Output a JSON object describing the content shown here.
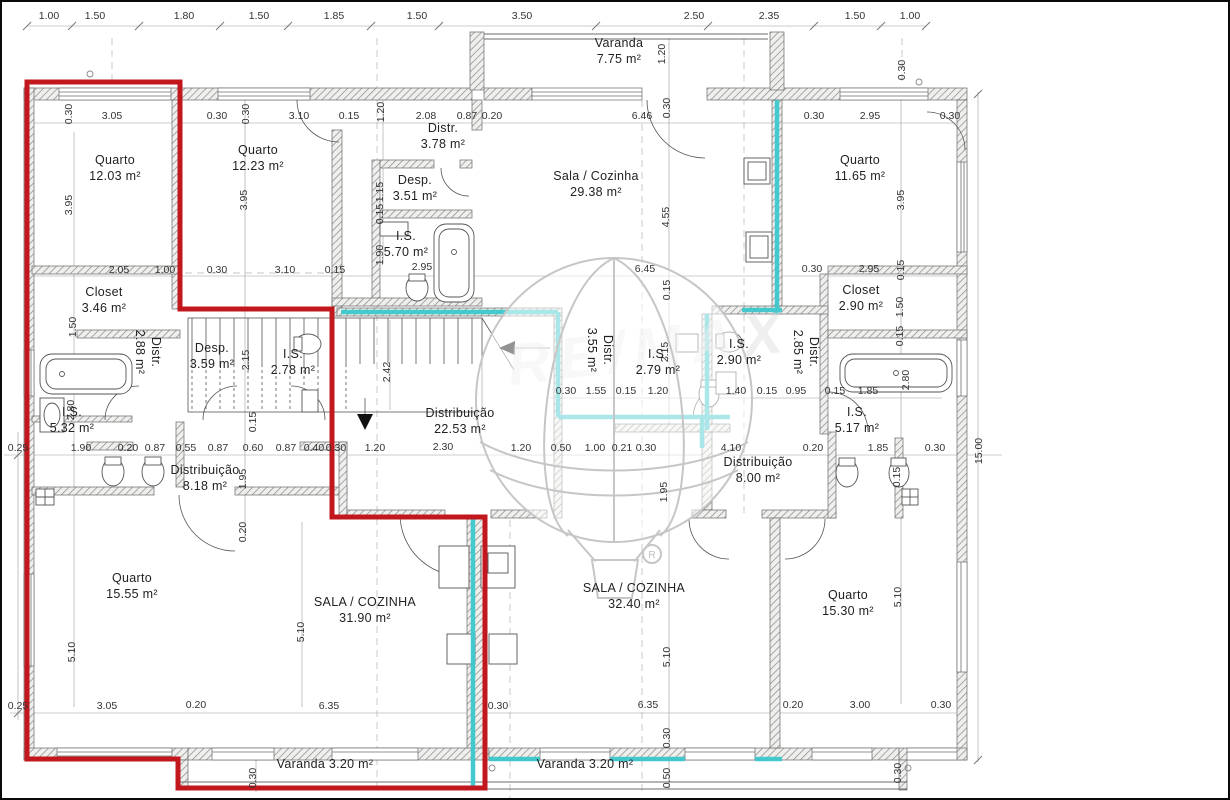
{
  "watermark": {
    "brand": "RE/MAX",
    "registered": "R"
  },
  "colors": {
    "unit_outline_red": "#c2171d",
    "wall_highlight_cyan": "#3cc7cc",
    "wall_fill": "#efefed",
    "line_gray": "#555555"
  },
  "rooms": [
    {
      "name": "Quarto",
      "area": "12.03 m²",
      "x": 113,
      "y": 162
    },
    {
      "name": "Quarto",
      "area": "12.23 m²",
      "x": 256,
      "y": 152
    },
    {
      "name": "Distr.",
      "area": "3.78 m²",
      "x": 441,
      "y": 130
    },
    {
      "name": "Desp.",
      "area": "3.51 m²",
      "x": 413,
      "y": 182
    },
    {
      "name": "I.S.",
      "area": "5.70 m²",
      "x": 404,
      "y": 238
    },
    {
      "name": "Sala / Cozinha",
      "area": "29.38 m²",
      "x": 594,
      "y": 178
    },
    {
      "name": "Varanda",
      "area": "7.75 m²",
      "x": 617,
      "y": 45
    },
    {
      "name": "Quarto",
      "area": "11.65 m²",
      "x": 858,
      "y": 162
    },
    {
      "name": "Closet",
      "area": "3.46 m²",
      "x": 102,
      "y": 294
    },
    {
      "name": "Distr.",
      "area": "2.88 m²",
      "x": 150,
      "y": 350,
      "rot": 1
    },
    {
      "name": "Desp.",
      "area": "3.59 m²",
      "x": 210,
      "y": 350
    },
    {
      "name": "I.S.",
      "area": "2.78 m²",
      "x": 291,
      "y": 356
    },
    {
      "name": "I.S.",
      "area": "5.32 m²",
      "x": 70,
      "y": 414
    },
    {
      "name": "Distribuição",
      "area": "22.53 m²",
      "x": 458,
      "y": 415
    },
    {
      "name": "Distr.",
      "area": "3.55 m²",
      "x": 602,
      "y": 348,
      "rot": 1
    },
    {
      "name": "I.S.",
      "area": "2.79 m²",
      "x": 656,
      "y": 356
    },
    {
      "name": "I.S.",
      "area": "2.90 m²",
      "x": 737,
      "y": 346
    },
    {
      "name": "Distr.",
      "area": "2.85 m²",
      "x": 808,
      "y": 350,
      "rot": 1
    },
    {
      "name": "Closet",
      "area": "2.90 m²",
      "x": 859,
      "y": 292
    },
    {
      "name": "I.S.",
      "area": "5.17 m²",
      "x": 855,
      "y": 414
    },
    {
      "name": "Distribuição",
      "area": "8.18 m²",
      "x": 203,
      "y": 472
    },
    {
      "name": "Quarto",
      "area": "15.55 m²",
      "x": 130,
      "y": 580
    },
    {
      "name": "SALA / COZINHA",
      "area": "31.90 m²",
      "x": 363,
      "y": 604
    },
    {
      "name": "SALA / COZINHA",
      "area": "32.40 m²",
      "x": 632,
      "y": 590
    },
    {
      "name": "Distribuição",
      "area": "8.00 m²",
      "x": 756,
      "y": 464
    },
    {
      "name": "Quarto",
      "area": "15.30 m²",
      "x": 846,
      "y": 597
    },
    {
      "name": "Varanda",
      "area": "3.20 m²",
      "x": 323,
      "y": 766,
      "single": 1
    },
    {
      "name": "Varanda",
      "area": "3.20 m²",
      "x": 583,
      "y": 766,
      "single": 1
    }
  ],
  "dims": [
    {
      "t": "1.00",
      "x": 47,
      "y": 17
    },
    {
      "t": "1.50",
      "x": 93,
      "y": 17
    },
    {
      "t": "1.80",
      "x": 182,
      "y": 17
    },
    {
      "t": "1.50",
      "x": 257,
      "y": 17
    },
    {
      "t": "1.85",
      "x": 332,
      "y": 17
    },
    {
      "t": "1.50",
      "x": 415,
      "y": 17
    },
    {
      "t": "3.50",
      "x": 520,
      "y": 17
    },
    {
      "t": "2.50",
      "x": 692,
      "y": 17
    },
    {
      "t": "2.35",
      "x": 767,
      "y": 17
    },
    {
      "t": "1.50",
      "x": 853,
      "y": 17
    },
    {
      "t": "1.00",
      "x": 908,
      "y": 17
    },
    {
      "t": "1.20",
      "x": 663,
      "y": 52,
      "r": 1
    },
    {
      "t": "0.30",
      "x": 903,
      "y": 68,
      "r": 1
    },
    {
      "t": "0.30",
      "x": 70,
      "y": 112,
      "r": 1
    },
    {
      "t": "3.05",
      "x": 110,
      "y": 117
    },
    {
      "t": "0.30",
      "x": 215,
      "y": 117
    },
    {
      "t": "0.30",
      "x": 247,
      "y": 112,
      "r": 1
    },
    {
      "t": "3.10",
      "x": 297,
      "y": 117
    },
    {
      "t": "0.15",
      "x": 347,
      "y": 117
    },
    {
      "t": "1.20",
      "x": 382,
      "y": 110,
      "r": 1
    },
    {
      "t": "2.08",
      "x": 424,
      "y": 117
    },
    {
      "t": "0.87",
      "x": 465,
      "y": 117
    },
    {
      "t": "0.20",
      "x": 490,
      "y": 117
    },
    {
      "t": "6.46",
      "x": 640,
      "y": 117
    },
    {
      "t": "0.30",
      "x": 668,
      "y": 106,
      "r": 1
    },
    {
      "t": "0.30",
      "x": 812,
      "y": 117
    },
    {
      "t": "2.95",
      "x": 868,
      "y": 117
    },
    {
      "t": "0.30",
      "x": 948,
      "y": 117
    },
    {
      "t": "3.95",
      "x": 70,
      "y": 203,
      "r": 1
    },
    {
      "t": "3.95",
      "x": 245,
      "y": 198,
      "r": 1
    },
    {
      "t": "3.95",
      "x": 902,
      "y": 198,
      "r": 1
    },
    {
      "t": "1.15",
      "x": 381,
      "y": 190,
      "r": 1
    },
    {
      "t": "0.15",
      "x": 381,
      "y": 212,
      "r": 1
    },
    {
      "t": "1.90",
      "x": 381,
      "y": 253,
      "r": 1
    },
    {
      "t": "4.55",
      "x": 667,
      "y": 215,
      "r": 1
    },
    {
      "t": "0.15",
      "x": 668,
      "y": 288,
      "r": 1
    },
    {
      "t": "2.95",
      "x": 420,
      "y": 268
    },
    {
      "t": "2.05",
      "x": 117,
      "y": 271
    },
    {
      "t": "1.00",
      "x": 163,
      "y": 271
    },
    {
      "t": "0.30",
      "x": 215,
      "y": 271
    },
    {
      "t": "3.10",
      "x": 283,
      "y": 271
    },
    {
      "t": "0.15",
      "x": 333,
      "y": 271
    },
    {
      "t": "6.45",
      "x": 643,
      "y": 270
    },
    {
      "t": "0.30",
      "x": 810,
      "y": 270
    },
    {
      "t": "2.95",
      "x": 867,
      "y": 270
    },
    {
      "t": "0.15",
      "x": 902,
      "y": 268,
      "r": 1
    },
    {
      "t": "1.50",
      "x": 74,
      "y": 325,
      "r": 1
    },
    {
      "t": "2.15",
      "x": 247,
      "y": 358,
      "r": 1
    },
    {
      "t": "0.15",
      "x": 254,
      "y": 420,
      "r": 1
    },
    {
      "t": "2.80",
      "x": 72,
      "y": 408,
      "r": 1
    },
    {
      "t": "2.42",
      "x": 388,
      "y": 370,
      "r": 1
    },
    {
      "t": "2.15",
      "x": 666,
      "y": 350,
      "r": 1
    },
    {
      "t": "1.50",
      "x": 901,
      "y": 305,
      "r": 1
    },
    {
      "t": "0.15",
      "x": 901,
      "y": 334,
      "r": 1
    },
    {
      "t": "2.80",
      "x": 907,
      "y": 378,
      "r": 1
    },
    {
      "t": "0.30",
      "x": 564,
      "y": 392
    },
    {
      "t": "1.55",
      "x": 594,
      "y": 392
    },
    {
      "t": "0.15",
      "x": 624,
      "y": 392
    },
    {
      "t": "1.20",
      "x": 656,
      "y": 392
    },
    {
      "t": "1.40",
      "x": 734,
      "y": 392
    },
    {
      "t": "0.15",
      "x": 765,
      "y": 392
    },
    {
      "t": "0.95",
      "x": 794,
      "y": 392
    },
    {
      "t": "0.15",
      "x": 833,
      "y": 392
    },
    {
      "t": "1.85",
      "x": 866,
      "y": 392
    },
    {
      "t": "0.25",
      "x": 16,
      "y": 449
    },
    {
      "t": "1.90",
      "x": 79,
      "y": 449
    },
    {
      "t": "0.20",
      "x": 126,
      "y": 449
    },
    {
      "t": "0.87",
      "x": 153,
      "y": 449
    },
    {
      "t": "0.55",
      "x": 184,
      "y": 449
    },
    {
      "t": "0.87",
      "x": 216,
      "y": 449
    },
    {
      "t": "0.60",
      "x": 251,
      "y": 449
    },
    {
      "t": "0.87",
      "x": 284,
      "y": 449
    },
    {
      "t": "0.40",
      "x": 312,
      "y": 449
    },
    {
      "t": "0.30",
      "x": 334,
      "y": 449
    },
    {
      "t": "1.20",
      "x": 373,
      "y": 449
    },
    {
      "t": "2.30",
      "x": 441,
      "y": 448
    },
    {
      "t": "1.20",
      "x": 519,
      "y": 449
    },
    {
      "t": "0.50",
      "x": 559,
      "y": 449
    },
    {
      "t": "1.00",
      "x": 593,
      "y": 449
    },
    {
      "t": "0.21",
      "x": 620,
      "y": 449
    },
    {
      "t": "0.30",
      "x": 644,
      "y": 449
    },
    {
      "t": "4.10",
      "x": 729,
      "y": 449
    },
    {
      "t": "0.20",
      "x": 811,
      "y": 449
    },
    {
      "t": "1.85",
      "x": 876,
      "y": 449
    },
    {
      "t": "0.30",
      "x": 933,
      "y": 449
    },
    {
      "t": "15.00",
      "x": 980,
      "y": 449,
      "r": 1
    },
    {
      "t": "1.95",
      "x": 244,
      "y": 477,
      "r": 1
    },
    {
      "t": "0.20",
      "x": 244,
      "y": 530,
      "r": 1
    },
    {
      "t": "1.95",
      "x": 665,
      "y": 490,
      "r": 1
    },
    {
      "t": "0.15",
      "x": 898,
      "y": 475,
      "r": 1
    },
    {
      "t": "5.10",
      "x": 73,
      "y": 650,
      "r": 1
    },
    {
      "t": "5.10",
      "x": 302,
      "y": 630,
      "r": 1
    },
    {
      "t": "5.10",
      "x": 668,
      "y": 655,
      "r": 1
    },
    {
      "t": "5.10",
      "x": 899,
      "y": 595,
      "r": 1
    },
    {
      "t": "0.30",
      "x": 668,
      "y": 736,
      "r": 1
    },
    {
      "t": "0.50",
      "x": 668,
      "y": 776,
      "r": 1
    },
    {
      "t": "0.30",
      "x": 254,
      "y": 776,
      "r": 1
    },
    {
      "t": "0.30",
      "x": 899,
      "y": 771,
      "r": 1
    },
    {
      "t": "0.25",
      "x": 16,
      "y": 707
    },
    {
      "t": "3.05",
      "x": 105,
      "y": 707
    },
    {
      "t": "0.20",
      "x": 194,
      "y": 706
    },
    {
      "t": "6.35",
      "x": 327,
      "y": 707
    },
    {
      "t": "0.30",
      "x": 496,
      "y": 707
    },
    {
      "t": "6.35",
      "x": 646,
      "y": 706
    },
    {
      "t": "0.20",
      "x": 791,
      "y": 706
    },
    {
      "t": "3.00",
      "x": 858,
      "y": 706
    },
    {
      "t": "0.30",
      "x": 939,
      "y": 706
    }
  ]
}
